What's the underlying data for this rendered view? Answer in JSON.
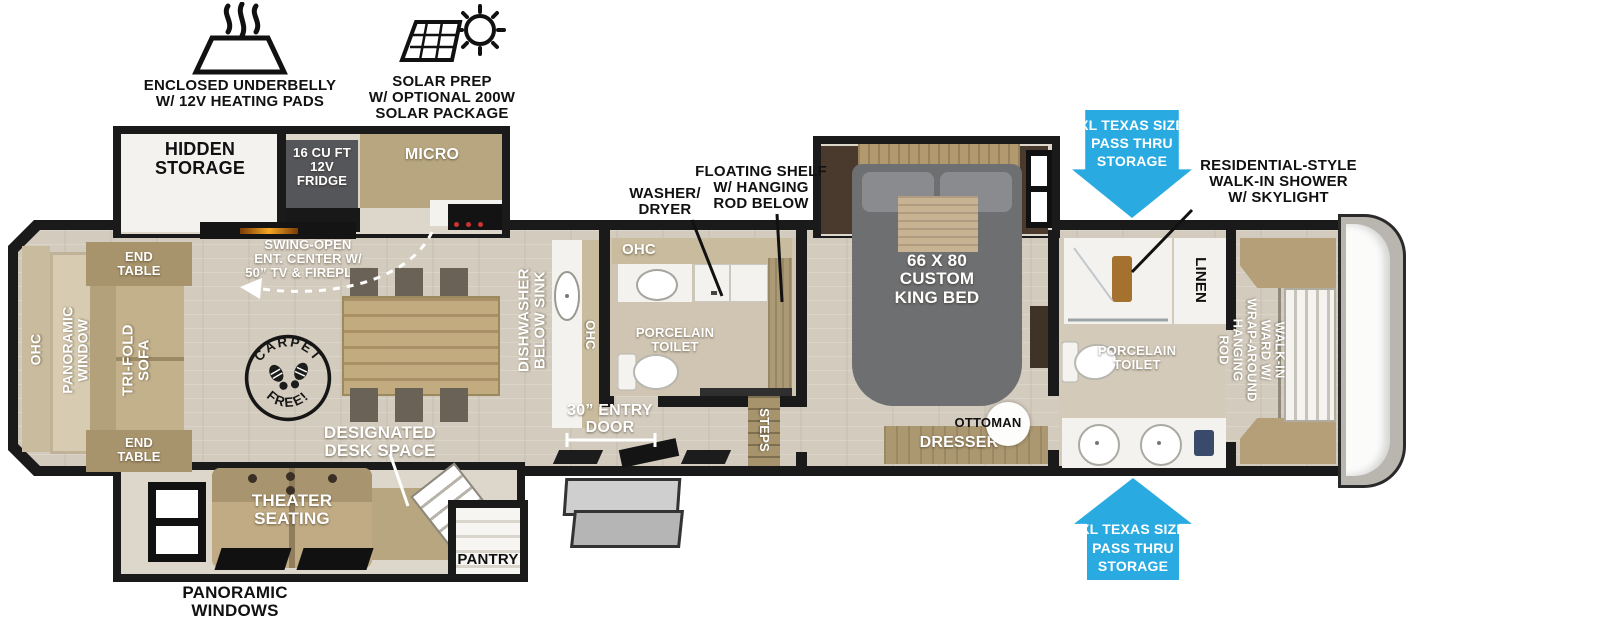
{
  "exterior_callouts": {
    "underbelly": "ENCLOSED UNDERBELLY\nW/ 12V HEATING PADS",
    "solar": "SOLAR PREP\nW/ OPTIONAL 200W\nSOLAR PACKAGE",
    "washer_dryer": "WASHER/\nDRYER",
    "floating_shelf": "FLOATING SHELF\nW/ HANGING\nROD BELOW",
    "shower": "RESIDENTIAL-STYLE\nWALK-IN SHOWER\nW/ SKYLIGHT",
    "pass_thru_top": "XL TEXAS SIZE\nPASS THRU\nSTORAGE",
    "pass_thru_bottom": "XL TEXAS SIZE\nPASS THRU\nSTORAGE",
    "panoramic_windows": "PANORAMIC\nWINDOWS"
  },
  "kitchen": {
    "hidden_storage": "HIDDEN\nSTORAGE",
    "fridge": "16 CU FT\n12V\nFRIDGE",
    "micro": "MICRO",
    "ent_center": "SWING-OPEN\nENT. CENTER W/\n50” TV & FIREPLCE",
    "dishwasher": "DISHWASHER\nBELOW SINK",
    "ohc": "OHC",
    "pantry": "PANTRY"
  },
  "living": {
    "end_table_top": "END\nTABLE",
    "end_table_bottom": "END\nTABLE",
    "ohc": "OHC",
    "panoramic_window": "PANORAMIC\nWINDOW",
    "trifold_sofa": "TRI-FOLD\nSOFA",
    "carpet_word": "CARPET",
    "free_word": "FREE!",
    "desk_space": "DESIGNATED\nDESK SPACE",
    "theater_seating": "THEATER\nSEATING"
  },
  "mid_bath": {
    "ohc": "OHC",
    "toilet": "PORCELAIN\nTOILET"
  },
  "entry": {
    "door": "30” ENTRY\nDOOR",
    "steps": "STEPS"
  },
  "bedroom": {
    "bed": "66 X 80\nCUSTOM\nKING BED",
    "dresser": "DRESSER",
    "ottoman": "OTTOMAN"
  },
  "front_bath": {
    "linen": "LINEN",
    "toilet": "PORCELAIN\nTOILET",
    "walk_in_ward": "WALK-IN\nWARD W/\nWRAP-AROUND\nHANGING\nROD"
  },
  "colors": {
    "arrow_blue": "#29abe2",
    "wall_black": "#1a1a1a",
    "floor_tan": "#d3cbbd",
    "cabinet_wood": "#b7a67f",
    "dark_wood": "#46382c",
    "bed_gray": "#6e6f71"
  }
}
